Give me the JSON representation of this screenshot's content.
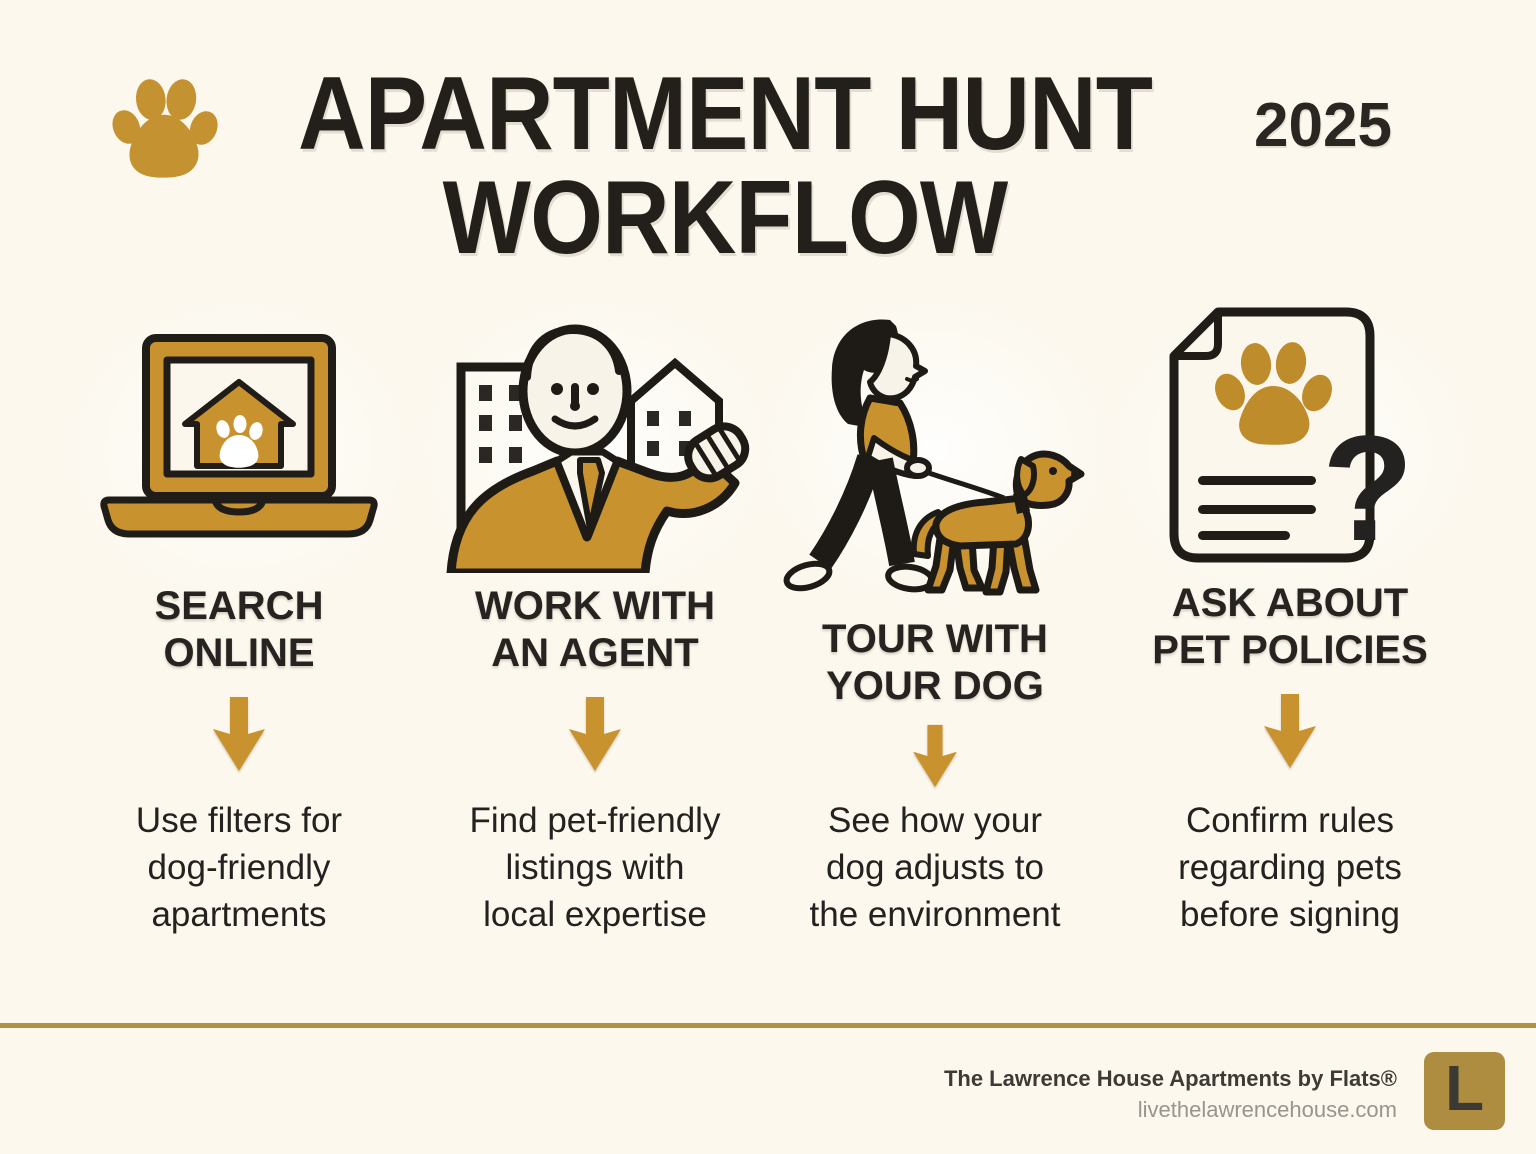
{
  "page": {
    "background": "#FCF8EE",
    "accent_gold": "#C8922E",
    "ink": "#242220",
    "rule_gold": "#B29044"
  },
  "header": {
    "paw_icon": "paw-print-icon",
    "title_line1": "APARTMENT HUNT",
    "title_line2": "WORKFLOW",
    "year": "2025"
  },
  "steps": [
    {
      "icon": "laptop-house-paw-icon",
      "title_lines": [
        "SEARCH",
        "ONLINE"
      ],
      "description_lines": [
        "Use filters for",
        "dog-friendly",
        "apartments"
      ]
    },
    {
      "icon": "real-estate-agent-icon",
      "title_lines": [
        "WORK WITH",
        "AN AGENT"
      ],
      "description_lines": [
        "Find pet-friendly",
        "listings with",
        "local expertise"
      ]
    },
    {
      "icon": "woman-walking-dog-icon",
      "title_lines": [
        "TOUR WITH",
        "YOUR DOG"
      ],
      "description_lines": [
        "See how your",
        "dog adjusts to",
        "the environment"
      ]
    },
    {
      "icon": "pet-policy-document-icon",
      "title_lines": [
        "ASK ABOUT",
        "PET POLICIES"
      ],
      "description_lines": [
        "Confirm rules",
        "regarding pets",
        "before signing"
      ]
    }
  ],
  "footer": {
    "brand": "The Lawrence House Apartments by Flats®",
    "website": "livethelawrencehouse.com",
    "logo_letter": "L",
    "logo_background": "#AE8D41"
  }
}
